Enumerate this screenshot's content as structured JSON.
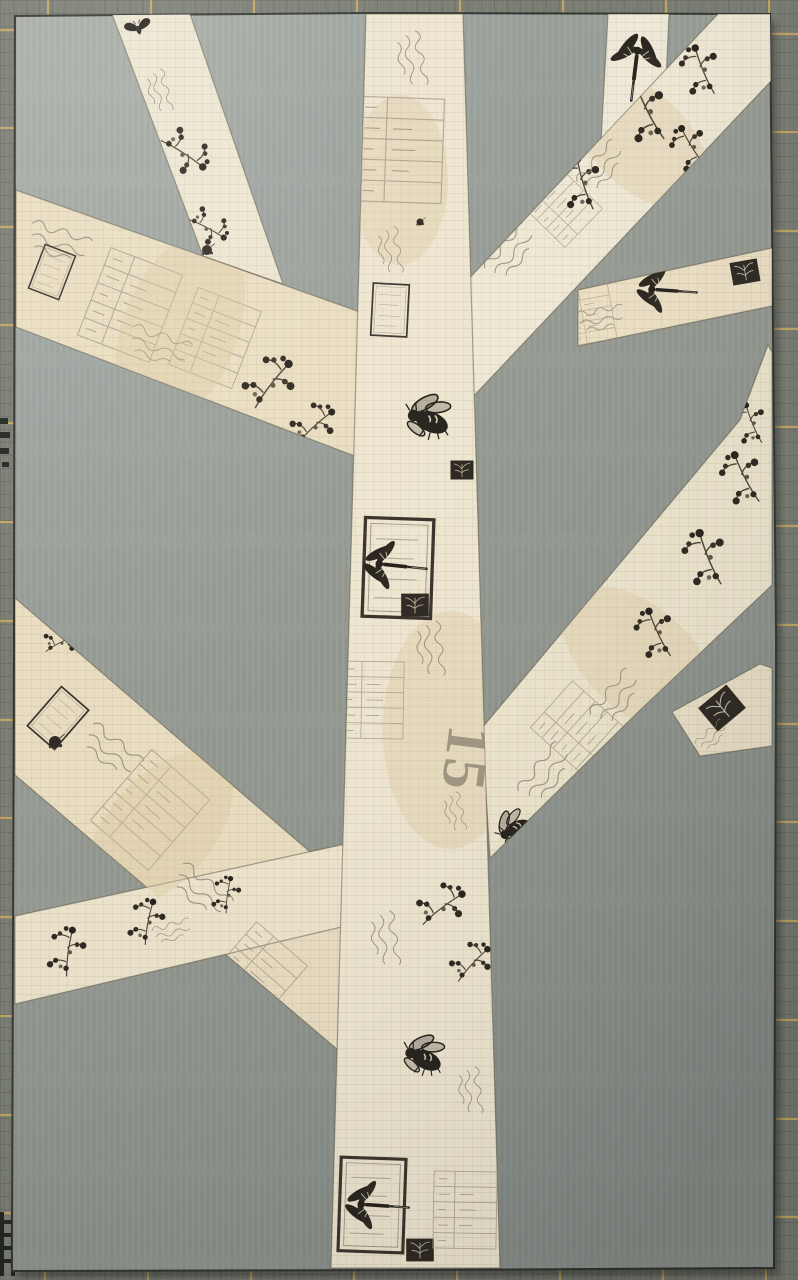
{
  "scene": {
    "description": "Photograph of a paper-pieced quilt block: a tree made of cream vintage insect-and-botanical print fabric strips sewn onto a gray fabric background, lying on a dark olive cutting mat with yellow grid lines",
    "print_text": {
      "value": "15"
    }
  },
  "colors": {
    "mat_base": "#767a6f",
    "mat_fine_grid": "#3c3e37",
    "mat_line": "#c9a75f",
    "mat_mark": "#20221e",
    "block_light": "#a9ada6",
    "block_mid": "#92978f",
    "block_dark": "#858b86",
    "block_edge": "#2e302b",
    "ink": "#221e18",
    "ink_soft": "#8d8471",
    "stain": "#d9c49c",
    "shadow": "#1b1d1a"
  },
  "mat": {
    "vlines_x": [
      48,
      151,
      254,
      357,
      460,
      563,
      666,
      769
    ],
    "hlines_y": [
      30,
      128,
      227,
      325,
      423,
      522,
      621,
      720,
      818,
      917,
      1016,
      1115,
      1213
    ],
    "marks": [
      {
        "x": 0,
        "y": 418,
        "w": 8,
        "h": 6
      },
      {
        "x": 0,
        "y": 432,
        "w": 10,
        "h": 6
      },
      {
        "x": 0,
        "y": 448,
        "w": 9,
        "h": 6
      },
      {
        "x": 2,
        "y": 462,
        "w": 7,
        "h": 5
      },
      {
        "x": 0,
        "y": 1212,
        "w": 4,
        "h": 64
      },
      {
        "x": 11,
        "y": 1212,
        "w": 4,
        "h": 64
      },
      {
        "x": 2,
        "y": 1220,
        "w": 10,
        "h": 4
      },
      {
        "x": 2,
        "y": 1233,
        "w": 10,
        "h": 4
      },
      {
        "x": 2,
        "y": 1246,
        "w": 10,
        "h": 4
      },
      {
        "x": 2,
        "y": 1259,
        "w": 10,
        "h": 4
      }
    ]
  },
  "block": {
    "points": "15,16 368,13 770,14 776,640 774,1268 420,1270 12,1271 14,640"
  },
  "strips": [
    {
      "id": "upper-left-narrow",
      "label": "upper left thin branch",
      "points": "112,14 190,14 283,284 203,256",
      "fill": "#ece5d0"
    },
    {
      "id": "upper-left-wide",
      "label": "upper left wide branch",
      "points": "16,190 16,327 360,458 360,312",
      "fill": "#e9ddbf"
    },
    {
      "id": "top-right-stub",
      "label": "top edge branch tip",
      "points": "608,14 669,14 662,170 600,160",
      "fill": "#efe9d8"
    },
    {
      "id": "right-horizontal",
      "label": "right horizontal branch",
      "points": "578,290 772,248 772,306 578,346",
      "fill": "#ebdfc4"
    },
    {
      "id": "upper-right-wide",
      "label": "upper right wide branch",
      "points": "463,285 718,14 772,14 772,80 468,402",
      "fill": "#eee8d4"
    },
    {
      "id": "lower-left-wide",
      "label": "lower left wide branch",
      "points": "15,598 15,775 345,1056 345,882",
      "fill": "#e8dcc0"
    },
    {
      "id": "lower-left-narrow",
      "label": "lower left thin branch",
      "points": "15,916 15,1004 350,925 350,843",
      "fill": "#ece3cb"
    },
    {
      "id": "right-stub",
      "label": "right edge branch stub",
      "points": "672,712 760,664 772,668 772,746 700,756",
      "fill": "#e9dfc6"
    },
    {
      "id": "lower-right-wide",
      "label": "lower right wide branch",
      "points": "482,728 740,420 768,345 772,352 772,585 640,710 490,858",
      "fill": "#ece4cc"
    },
    {
      "id": "trunk",
      "label": "tree trunk",
      "points": "366,14 463,14 500,1268 331,1268",
      "fill": "#ede5cf"
    }
  ],
  "motifs": [
    {
      "s": "moth",
      "x": 138,
      "y": 27,
      "sc": 0.55,
      "rot": -15,
      "clip": "upper-left-narrow"
    },
    {
      "s": "script",
      "x": 160,
      "y": 100,
      "sc": 0.55,
      "rot": 78,
      "clip": "upper-left-narrow"
    },
    {
      "s": "sprig",
      "x": 185,
      "y": 150,
      "sc": 0.85,
      "rot": 100,
      "clip": "upper-left-narrow"
    },
    {
      "s": "sprig",
      "x": 208,
      "y": 225,
      "sc": 0.7,
      "rot": 95,
      "clip": "upper-left-narrow"
    },
    {
      "s": "blob",
      "x": 207,
      "y": 250,
      "sc": 0.5,
      "rot": 0,
      "clip": "upper-left-narrow"
    },
    {
      "s": "script",
      "x": 70,
      "y": 248,
      "sc": 0.8,
      "rot": 21,
      "clip": "upper-left-wide"
    },
    {
      "s": "stampbox",
      "x": 52,
      "y": 272,
      "sc": 0.45,
      "rot": 21,
      "clip": "upper-left-wide"
    },
    {
      "s": "receipt",
      "x": 130,
      "y": 305,
      "sc": 0.85,
      "rot": 21,
      "clip": "upper-left-wide"
    },
    {
      "s": "receipt",
      "x": 215,
      "y": 338,
      "sc": 0.75,
      "rot": 21,
      "clip": "upper-left-wide"
    },
    {
      "s": "script",
      "x": 170,
      "y": 352,
      "sc": 0.8,
      "rot": 21,
      "clip": "upper-left-wide"
    },
    {
      "s": "stain",
      "x": 180,
      "y": 330,
      "sc": 1.2,
      "rot": 21,
      "clip": "upper-left-wide"
    },
    {
      "s": "sprig",
      "x": 268,
      "y": 382,
      "sc": 0.95,
      "rot": 15,
      "clip": "upper-left-wide"
    },
    {
      "s": "sprig",
      "x": 312,
      "y": 424,
      "sc": 0.8,
      "rot": 25,
      "clip": "upper-left-wide"
    },
    {
      "s": "dragonfly",
      "x": 636,
      "y": 62,
      "sc": 0.95,
      "rot": 97,
      "clip": "top-right-stub"
    },
    {
      "s": "script",
      "x": 610,
      "y": 318,
      "sc": 0.6,
      "rot": -8,
      "clip": "right-horizontal"
    },
    {
      "s": "receipt",
      "x": 590,
      "y": 315,
      "sc": 0.5,
      "rot": -10,
      "clip": "right-horizontal"
    },
    {
      "s": "dragonfly",
      "x": 662,
      "y": 290,
      "sc": 0.85,
      "rot": 4,
      "clip": "right-horizontal"
    },
    {
      "s": "stampfill",
      "x": 745,
      "y": 272,
      "sc": 0.6,
      "rot": -10,
      "clip": "right-horizontal"
    },
    {
      "s": "script",
      "x": 520,
      "y": 245,
      "sc": 0.75,
      "rot": -46,
      "clip": "upper-right-wide"
    },
    {
      "s": "receipt",
      "x": 560,
      "y": 205,
      "sc": 0.6,
      "rot": -46,
      "clip": "upper-right-wide"
    },
    {
      "s": "stain",
      "x": 640,
      "y": 140,
      "sc": 1.0,
      "rot": -46,
      "clip": "upper-right-wide"
    },
    {
      "s": "sprig",
      "x": 580,
      "y": 185,
      "sc": 0.9,
      "rot": -40,
      "clip": "upper-right-wide"
    },
    {
      "s": "sprig",
      "x": 645,
      "y": 115,
      "sc": 1.0,
      "rot": -50,
      "clip": "upper-right-wide"
    },
    {
      "s": "sprig",
      "x": 700,
      "y": 72,
      "sc": 0.85,
      "rot": -45,
      "clip": "upper-right-wide"
    },
    {
      "s": "sprig",
      "x": 690,
      "y": 150,
      "sc": 0.8,
      "rot": -55,
      "clip": "upper-right-wide"
    },
    {
      "s": "script",
      "x": 610,
      "y": 160,
      "sc": 0.7,
      "rot": -46,
      "clip": "upper-right-wide"
    },
    {
      "s": "sprig",
      "x": 60,
      "y": 640,
      "sc": 0.6,
      "rot": 40,
      "clip": "lower-left-wide"
    },
    {
      "s": "stampbox",
      "x": 58,
      "y": 718,
      "sc": 0.5,
      "rot": 41,
      "clip": "lower-left-wide"
    },
    {
      "s": "blob",
      "x": 55,
      "y": 742,
      "sc": 0.6,
      "rot": 0,
      "clip": "lower-left-wide"
    },
    {
      "s": "script",
      "x": 120,
      "y": 760,
      "sc": 0.8,
      "rot": 41,
      "clip": "lower-left-wide"
    },
    {
      "s": "receipt",
      "x": 150,
      "y": 810,
      "sc": 0.85,
      "rot": 41,
      "clip": "lower-left-wide"
    },
    {
      "s": "stain",
      "x": 160,
      "y": 830,
      "sc": 1.1,
      "rot": 41,
      "clip": "lower-left-wide"
    },
    {
      "s": "script",
      "x": 210,
      "y": 900,
      "sc": 0.8,
      "rot": 41,
      "clip": "lower-left-wide"
    },
    {
      "s": "receipt",
      "x": 255,
      "y": 975,
      "sc": 0.75,
      "rot": 41,
      "clip": "lower-left-wide"
    },
    {
      "s": "sprig",
      "x": 65,
      "y": 952,
      "sc": 0.8,
      "rot": -15,
      "clip": "lower-left-narrow"
    },
    {
      "s": "sprig",
      "x": 145,
      "y": 922,
      "sc": 0.75,
      "rot": -12,
      "clip": "lower-left-narrow"
    },
    {
      "s": "sprig",
      "x": 225,
      "y": 895,
      "sc": 0.6,
      "rot": -15,
      "clip": "lower-left-narrow"
    },
    {
      "s": "script",
      "x": 180,
      "y": 930,
      "sc": 0.5,
      "rot": -14,
      "clip": "lower-left-narrow"
    },
    {
      "s": "stampfill",
      "x": 722,
      "y": 708,
      "sc": 0.8,
      "rot": -40,
      "clip": "right-stub"
    },
    {
      "s": "script",
      "x": 718,
      "y": 732,
      "sc": 0.45,
      "rot": -40,
      "clip": "right-stub"
    },
    {
      "s": "script",
      "x": 555,
      "y": 765,
      "sc": 0.8,
      "rot": -48,
      "clip": "lower-right-wide"
    },
    {
      "s": "receipt",
      "x": 580,
      "y": 730,
      "sc": 0.7,
      "rot": -48,
      "clip": "lower-right-wide"
    },
    {
      "s": "stain",
      "x": 640,
      "y": 660,
      "sc": 1.1,
      "rot": -48,
      "clip": "lower-right-wide"
    },
    {
      "s": "script",
      "x": 625,
      "y": 690,
      "sc": 0.75,
      "rot": -48,
      "clip": "lower-right-wide"
    },
    {
      "s": "sprig",
      "x": 655,
      "y": 635,
      "sc": 0.85,
      "rot": -48,
      "clip": "lower-right-wide"
    },
    {
      "s": "sprig",
      "x": 705,
      "y": 560,
      "sc": 0.95,
      "rot": -45,
      "clip": "lower-right-wide"
    },
    {
      "s": "sprig",
      "x": 742,
      "y": 480,
      "sc": 0.9,
      "rot": -50,
      "clip": "lower-right-wide"
    },
    {
      "s": "sprig",
      "x": 750,
      "y": 425,
      "sc": 0.7,
      "rot": -45,
      "clip": "lower-right-wide"
    },
    {
      "s": "bee",
      "x": 516,
      "y": 828,
      "sc": 0.8,
      "rot": -38,
      "clip": "lower-right-wide"
    },
    {
      "s": "stain",
      "x": 450,
      "y": 730,
      "sc": 1.4,
      "rot": 0,
      "clip": "trunk"
    },
    {
      "s": "stain",
      "x": 400,
      "y": 180,
      "sc": 1.0,
      "rot": 0,
      "clip": "trunk"
    },
    {
      "s": "script",
      "x": 412,
      "y": 70,
      "sc": 0.7,
      "rot": 82,
      "clip": "trunk"
    },
    {
      "s": "receipt",
      "x": 400,
      "y": 150,
      "sc": 0.95,
      "rot": 2,
      "clip": "trunk"
    },
    {
      "s": "blob",
      "x": 420,
      "y": 222,
      "sc": 0.35,
      "rot": 0,
      "clip": "trunk"
    },
    {
      "s": "script",
      "x": 390,
      "y": 260,
      "sc": 0.6,
      "rot": 84,
      "clip": "trunk"
    },
    {
      "s": "stampbox",
      "x": 390,
      "y": 310,
      "sc": 0.5,
      "rot": 3,
      "clip": "trunk"
    },
    {
      "s": "bee",
      "x": 430,
      "y": 420,
      "sc": 1.05,
      "rot": 8,
      "clip": "trunk"
    },
    {
      "s": "stampfill",
      "x": 462,
      "y": 470,
      "sc": 0.5,
      "rot": 0,
      "clip": "trunk"
    },
    {
      "s": "stampbox",
      "x": 398,
      "y": 568,
      "sc": 0.95,
      "rot": 2,
      "clip": "trunk"
    },
    {
      "s": "dragonfly",
      "x": 390,
      "y": 565,
      "sc": 0.9,
      "rot": 6,
      "clip": "trunk"
    },
    {
      "s": "stampfill",
      "x": 415,
      "y": 605,
      "sc": 0.6,
      "rot": 0,
      "clip": "trunk"
    },
    {
      "s": "script",
      "x": 430,
      "y": 660,
      "sc": 0.7,
      "rot": 86,
      "clip": "trunk"
    },
    {
      "s": "receipt",
      "x": 372,
      "y": 700,
      "sc": 0.7,
      "rot": 1,
      "clip": "trunk"
    },
    {
      "s": "text15",
      "x": 460,
      "y": 758,
      "sc": 1,
      "rot": 97,
      "clip": "trunk"
    },
    {
      "s": "script",
      "x": 455,
      "y": 820,
      "sc": 0.5,
      "rot": 80,
      "clip": "trunk"
    },
    {
      "s": "sprig",
      "x": 440,
      "y": 905,
      "sc": 0.85,
      "rot": 30,
      "clip": "trunk"
    },
    {
      "s": "sprig",
      "x": 470,
      "y": 962,
      "sc": 0.75,
      "rot": 20,
      "clip": "trunk"
    },
    {
      "s": "script",
      "x": 385,
      "y": 950,
      "sc": 0.7,
      "rot": 84,
      "clip": "trunk"
    },
    {
      "s": "bee",
      "x": 425,
      "y": 1058,
      "sc": 0.95,
      "rot": 12,
      "clip": "trunk"
    },
    {
      "s": "script",
      "x": 470,
      "y": 1100,
      "sc": 0.6,
      "rot": 86,
      "clip": "trunk"
    },
    {
      "s": "stampbox",
      "x": 372,
      "y": 1205,
      "sc": 0.9,
      "rot": 2,
      "clip": "trunk"
    },
    {
      "s": "dragonfly",
      "x": 372,
      "y": 1205,
      "sc": 0.9,
      "rot": 4,
      "clip": "trunk"
    },
    {
      "s": "stampfill",
      "x": 420,
      "y": 1250,
      "sc": 0.6,
      "rot": 0,
      "clip": "trunk"
    },
    {
      "s": "receipt",
      "x": 465,
      "y": 1210,
      "sc": 0.7,
      "rot": 1,
      "clip": "trunk"
    }
  ]
}
